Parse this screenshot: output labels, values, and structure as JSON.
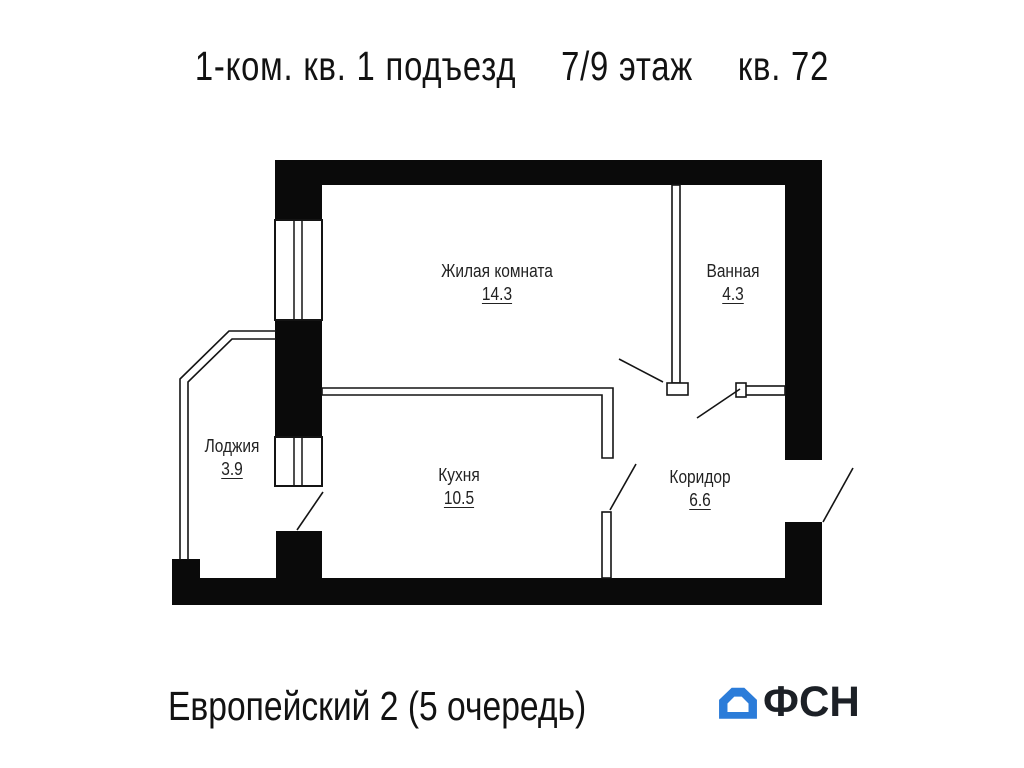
{
  "title": {
    "segments": [
      "1-ком. кв. 1 подъезд",
      "7/9 этаж",
      "кв. 72"
    ]
  },
  "plan": {
    "rooms": [
      {
        "name": "Жилая комната",
        "area": "14.3"
      },
      {
        "name": "Ванная",
        "area": "4.3"
      },
      {
        "name": "Лоджия",
        "area": "3.9"
      },
      {
        "name": "Кухня",
        "area": "10.5"
      },
      {
        "name": "Коридор",
        "area": "6.6"
      }
    ]
  },
  "footer": {
    "project": "Европейский 2 (5 очередь)",
    "logo_text": "ФСН",
    "logo_color": "#2b7cd9"
  },
  "colors": {
    "wall": "#0a0a0a",
    "line": "#141414"
  }
}
